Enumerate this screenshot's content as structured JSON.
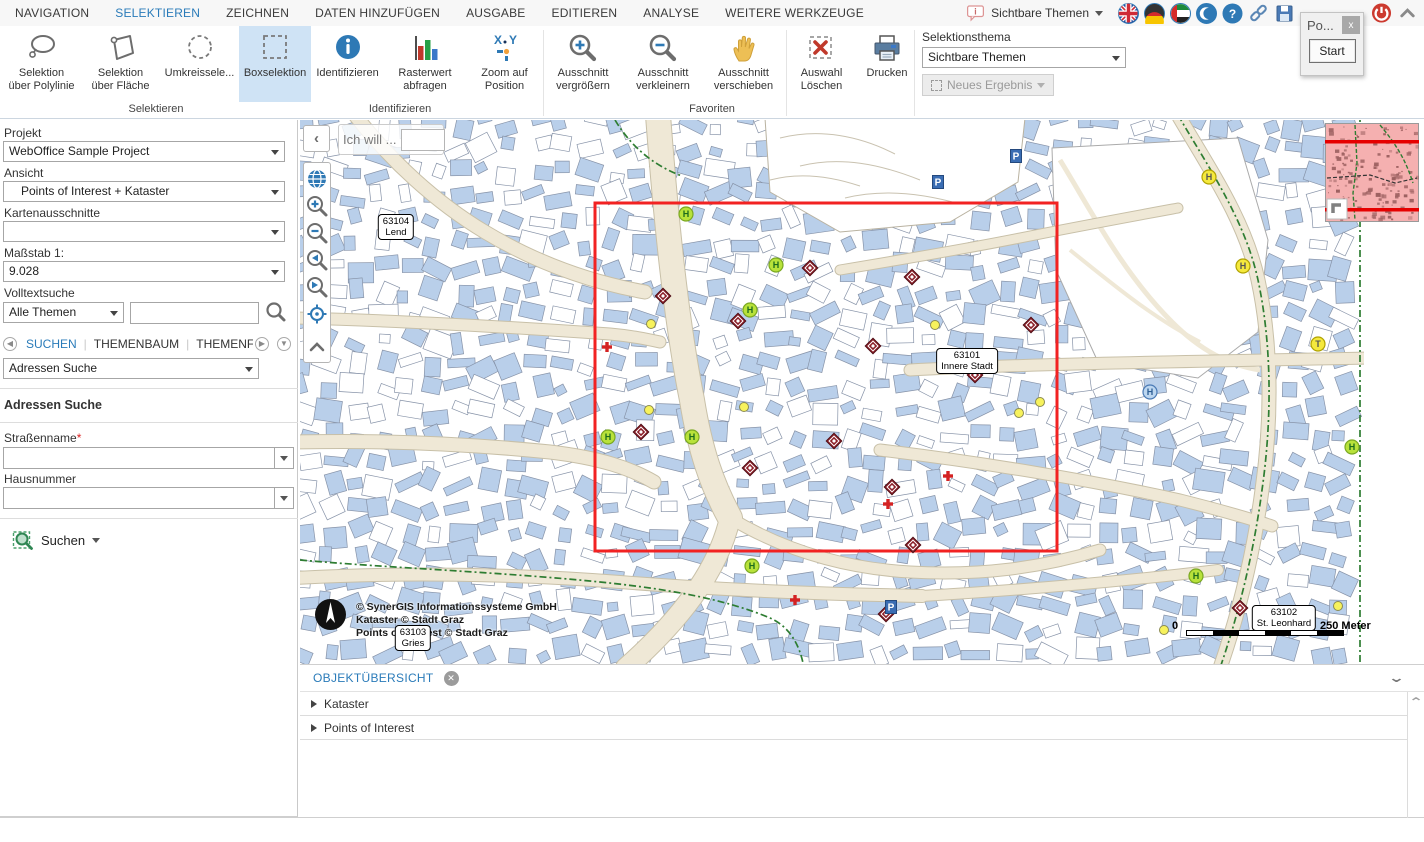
{
  "menu": {
    "tabs": [
      "NAVIGATION",
      "SELEKTIEREN",
      "ZEICHNEN",
      "DATEN HINZUFÜGEN",
      "AUSGABE",
      "EDITIEREN",
      "ANALYSE",
      "WEITERE WERKZEUGE"
    ],
    "active_tab": "SELEKTIEREN",
    "theme_quick_label": "Sichtbare Themen",
    "icon_names": [
      "info-bubble-icon",
      "flag-uk-icon",
      "flag-de-icon",
      "flag-ae-icon",
      "crescent-icon",
      "help-icon",
      "link-icon",
      "save-icon",
      "power-icon",
      "collapse-ribbon-icon"
    ]
  },
  "toolbar": {
    "tools": [
      {
        "name": "selektion-ueber-polylinie",
        "icon": "lasso",
        "lines": [
          "Selektion",
          "über Polylinie"
        ],
        "w": 79,
        "active": false
      },
      {
        "name": "selektion-ueber-flaeche",
        "icon": "polygon",
        "lines": [
          "Selektion",
          "über Fläche"
        ],
        "w": 79,
        "active": false
      },
      {
        "name": "umkreisselektion",
        "icon": "circle-dashed",
        "lines": [
          "Umkreissele..."
        ],
        "w": 79,
        "active": false
      },
      {
        "name": "boxselektion",
        "icon": "box-dashed",
        "lines": [
          "Boxselektion"
        ],
        "w": 72,
        "active": true
      },
      {
        "name": "identifizieren",
        "icon": "info",
        "lines": [
          "Identifizieren"
        ],
        "w": 73,
        "active": false
      },
      {
        "name": "rasterwert-abfragen",
        "icon": "barchart",
        "lines": [
          "Rasterwert",
          "abfragen"
        ],
        "w": 82,
        "active": false
      },
      {
        "name": "zoom-auf-position",
        "icon": "xy",
        "lines": [
          "Zoom auf",
          "Position"
        ],
        "w": 77,
        "active": false
      },
      {
        "name": "ausschnitt-vergroessern",
        "icon": "zoom-in",
        "lines": [
          "Ausschnitt",
          "vergrößern"
        ],
        "w": 80,
        "active": false
      },
      {
        "name": "ausschnitt-verkleinern",
        "icon": "zoom-out",
        "lines": [
          "Ausschnitt",
          "verkleinern"
        ],
        "w": 80,
        "active": false
      },
      {
        "name": "ausschnitt-verschieben",
        "icon": "hand",
        "lines": [
          "Ausschnitt",
          "verschieben"
        ],
        "w": 81,
        "active": false
      },
      {
        "name": "auswahl-loeschen",
        "icon": "delete-selection",
        "lines": [
          "Auswahl",
          "Löschen"
        ],
        "w": 75,
        "active": false
      },
      {
        "name": "drucken",
        "icon": "print",
        "lines": [
          "Drucken"
        ],
        "w": 56,
        "active": false
      }
    ],
    "groups": [
      {
        "label": "Selektieren",
        "cx": 156
      },
      {
        "label": "Identifizieren",
        "cx": 400
      },
      {
        "label": "Favoriten",
        "cx": 712
      }
    ],
    "separators_x": [
      543,
      786,
      914
    ],
    "selektionsthema": {
      "label": "Selektionsthema",
      "value": "Sichtbare Themen",
      "button": "Neues Ergebnis"
    }
  },
  "popup": {
    "title": "Po...",
    "close_label": "x",
    "start_label": "Start"
  },
  "sidebar": {
    "projekt_label": "Projekt",
    "projekt_value": "WebOffice Sample Project",
    "ansicht_label": "Ansicht",
    "ansicht_value": "Points of Interest + Kataster",
    "kartenausschnitte_label": "Kartenausschnitte",
    "kartenausschnitte_value": "",
    "massstab_label": "Maßstab 1:",
    "massstab_value": "9.028",
    "volltextsuche_label": "Volltextsuche",
    "volltext_scope": "Alle Themen",
    "volltext_value": "",
    "tabs": [
      {
        "label": "SUCHEN",
        "active": true
      },
      {
        "label": "THEMENBAUM",
        "active": false
      },
      {
        "label": "THEMENFILTER",
        "active": false
      }
    ],
    "search_select_value": "Adressen Suche",
    "section_title": "Adressen Suche",
    "fields": [
      {
        "label": "Straßenname",
        "required": true,
        "value": ""
      },
      {
        "label": "Hausnummer",
        "required": false,
        "value": ""
      }
    ],
    "suchen_button_label": "Suchen"
  },
  "map": {
    "ich_will_label": "Ich will ...",
    "selection_rect": [
      595,
      203,
      462,
      348
    ],
    "labels": [
      {
        "line1": "63104",
        "line2": "Lend",
        "x": 396,
        "y": 227
      },
      {
        "line1": "63101",
        "line2": "Innere Stadt",
        "x": 967,
        "y": 361
      },
      {
        "line1": "63102",
        "line2": "St. Leonhard",
        "x": 1284,
        "y": 618
      },
      {
        "line1": "63103",
        "line2": "Gries",
        "x": 413,
        "y": 638
      }
    ],
    "pois": {
      "diamonds": [
        [
          663,
          296
        ],
        [
          738,
          321
        ],
        [
          810,
          268
        ],
        [
          873,
          346
        ],
        [
          912,
          277
        ],
        [
          1031,
          325
        ],
        [
          975,
          375
        ],
        [
          641,
          432
        ],
        [
          834,
          441
        ],
        [
          750,
          468
        ],
        [
          892,
          487
        ],
        [
          913,
          545
        ],
        [
          1240,
          608
        ],
        [
          886,
          614
        ]
      ],
      "red_crosses": [
        [
          607,
          347
        ],
        [
          888,
          504
        ],
        [
          795,
          600
        ],
        [
          948,
          476
        ]
      ],
      "green_h": [
        [
          686,
          214
        ],
        [
          776,
          265
        ],
        [
          750,
          310
        ],
        [
          608,
          437
        ],
        [
          692,
          437
        ],
        [
          752,
          566
        ],
        [
          1196,
          576
        ],
        [
          1352,
          447
        ]
      ],
      "yellow_h": [
        [
          1209,
          177
        ],
        [
          1243,
          266
        ]
      ],
      "yellow_t": [
        [
          1318,
          344
        ]
      ],
      "blue_h": [
        [
          1150,
          392
        ]
      ],
      "yellow_dots": [
        [
          649,
          410
        ],
        [
          744,
          407
        ],
        [
          1019,
          413
        ],
        [
          1040,
          402
        ],
        [
          935,
          325
        ],
        [
          651,
          324
        ],
        [
          1338,
          606
        ],
        [
          1164,
          630
        ]
      ],
      "blue_p": [
        [
          1016,
          156
        ],
        [
          938,
          182
        ],
        [
          891,
          607
        ]
      ]
    },
    "copyright": [
      "© SynerGIS Informationssysteme GmbH",
      "Kataster © Stadt Graz",
      "Points of Interest © Stadt Graz"
    ],
    "scalebar": {
      "left": "0",
      "right": "250 Meter"
    }
  },
  "bottom_panel": {
    "title": "OBJEKTÜBERSICHT",
    "items": [
      "Kataster",
      "Points of Interest"
    ]
  }
}
